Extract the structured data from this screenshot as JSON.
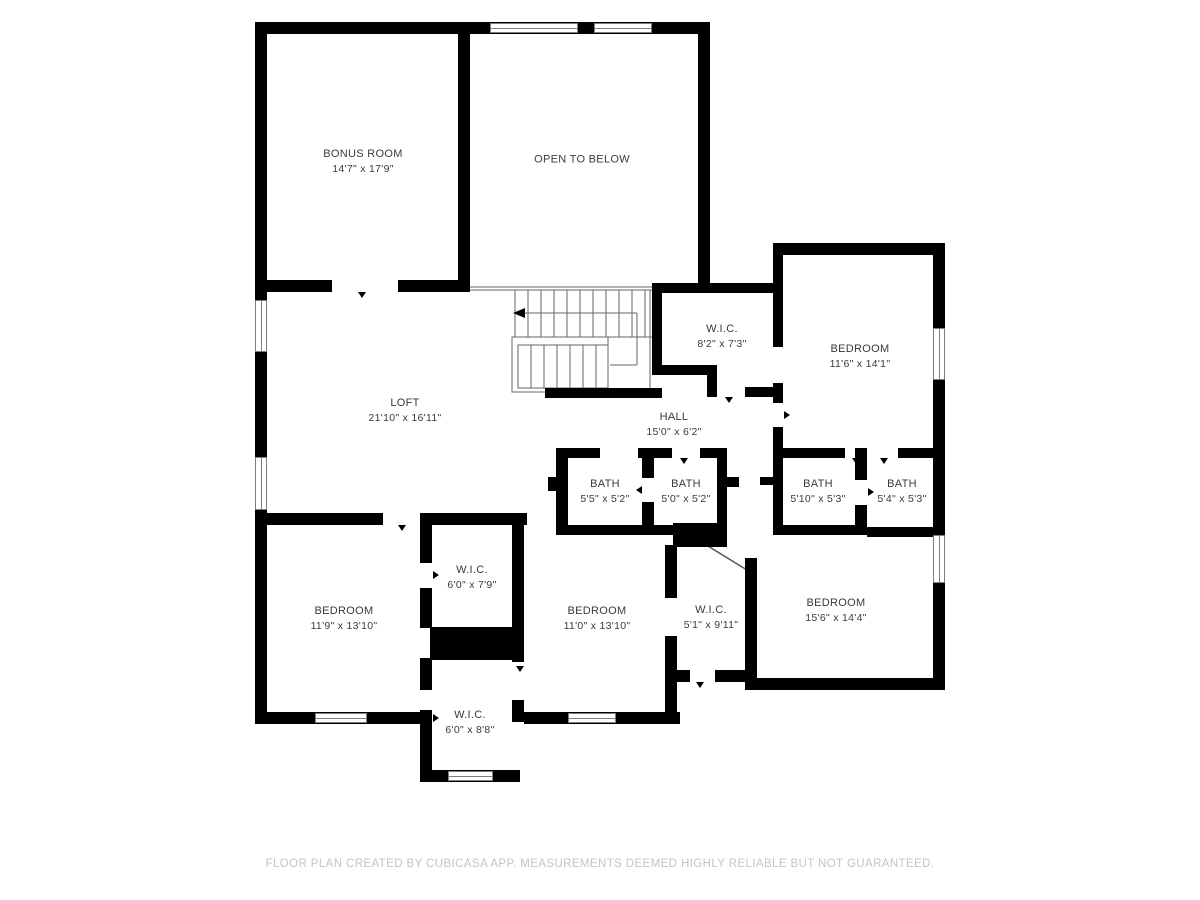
{
  "meta": {
    "app_attribution": "CubiCasa",
    "plan_type": "floor-plan"
  },
  "colors": {
    "background": "#ffffff",
    "wall": "#000000",
    "room_label": "#3a3a3a",
    "footer_text": "#c4c4c4",
    "window_outline": "#7d7d7d",
    "stair_lines": "#666666"
  },
  "rooms": {
    "bonus": {
      "name": "BONUS ROOM",
      "dims": "14'7\" x 17'9\""
    },
    "open_to_below": {
      "name": "OPEN TO BELOW"
    },
    "wic_upper": {
      "name": "W.I.C.",
      "dims": "8'2\" x 7'3\""
    },
    "bedroom_ne": {
      "name": "BEDROOM",
      "dims": "11'6\" x 14'1\""
    },
    "loft": {
      "name": "LOFT",
      "dims": "21'10\" x 16'11\""
    },
    "hall": {
      "name": "HALL",
      "dims": "15'0\" x 6'2\""
    },
    "bath_a": {
      "name": "BATH",
      "dims": "5'5\" x 5'2\""
    },
    "bath_b": {
      "name": "BATH",
      "dims": "5'0\" x 5'2\""
    },
    "bath_c": {
      "name": "BATH",
      "dims": "5'10\" x 5'3\""
    },
    "bath_d": {
      "name": "BATH",
      "dims": "5'4\" x 5'3\""
    },
    "bedroom_sw": {
      "name": "BEDROOM",
      "dims": "11'9\" x 13'10\""
    },
    "wic_mid": {
      "name": "W.I.C.",
      "dims": "6'0\" x 7'9\""
    },
    "wic_low": {
      "name": "W.I.C.",
      "dims": "6'0\" x 8'8\""
    },
    "bedroom_s": {
      "name": "BEDROOM",
      "dims": "11'0\" x 13'10\""
    },
    "wic_s": {
      "name": "W.I.C.",
      "dims": "5'1\" x 9'11\""
    },
    "bedroom_se": {
      "name": "BEDROOM",
      "dims": "15'6\" x 14'4\""
    }
  },
  "footer": {
    "text": "FLOOR PLAN CREATED BY CUBICASA APP. MEASUREMENTS DEEMED HIGHLY RELIABLE BUT NOT GUARANTEED."
  }
}
